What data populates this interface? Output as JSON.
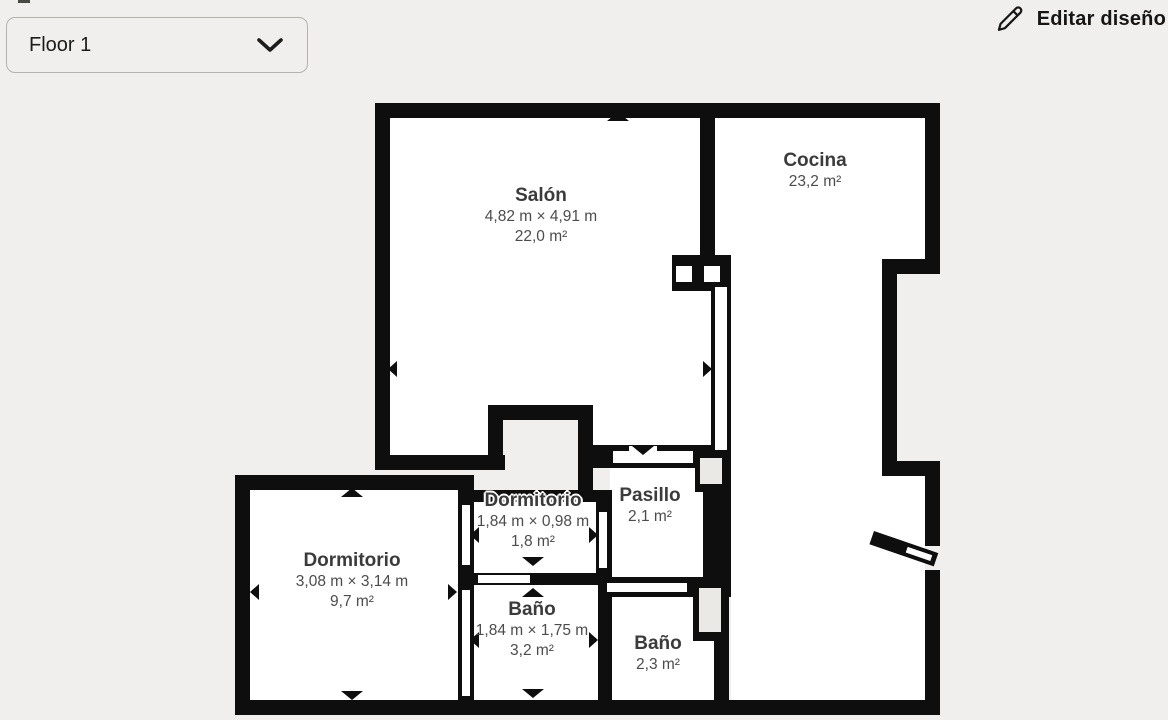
{
  "toolbar": {
    "floor_selector": {
      "value": "Floor 1"
    },
    "edit_button": {
      "label": "Editar diseño"
    }
  },
  "rooms": {
    "salon": {
      "name": "Salón",
      "dimensions": "4,82 m × 4,91 m",
      "area": "22,0 m²"
    },
    "cocina": {
      "name": "Cocina",
      "dimensions": "",
      "area": "23,2 m²"
    },
    "dormitorio_left": {
      "name": "Dormitorio",
      "dimensions": "3,08 m × 3,14 m",
      "area": "9,7 m²"
    },
    "dormitorio_small": {
      "name": "Dormitorio",
      "dimensions": "1,84 m × 0,98 m",
      "area": "1,8 m²"
    },
    "pasillo": {
      "name": "Pasillo",
      "dimensions": "",
      "area": "2,1 m²"
    },
    "bano_middle": {
      "name": "Baño",
      "dimensions": "1,84 m × 1,75 m",
      "area": "3,2 m²"
    },
    "bano_right": {
      "name": "Baño",
      "dimensions": "",
      "area": "2,3 m²"
    }
  },
  "icons": {
    "floor_selector": "chevron-down-icon",
    "edit_button": "pencil-icon",
    "plan_markers": "direction-arrow-icons"
  },
  "colors": {
    "background": "#f0efed",
    "wall": "#0e0e0e",
    "room_fill": "#ffffff",
    "title_text": "#3b3b3b",
    "dimension_text": "#4c4c4c",
    "control_border": "#b5b2ae"
  }
}
